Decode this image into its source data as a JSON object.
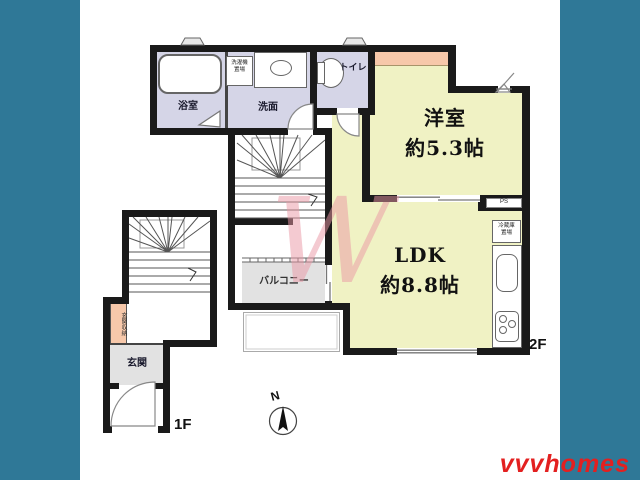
{
  "brand": {
    "logo_text": "vvvhomes",
    "logo_color": "#e32020",
    "watermark_letter": "W"
  },
  "compass": {
    "north_label": "N"
  },
  "floor_labels": {
    "second": "2F",
    "first": "1F"
  },
  "rooms": {
    "bath": {
      "name": "浴室"
    },
    "washroom": {
      "name": "洗面"
    },
    "laundry_space": {
      "name_line1": "洗濯機",
      "name_line2": "置場"
    },
    "toilet": {
      "name": "トイレ"
    },
    "western_room": {
      "name": "洋室",
      "size": "約5.3帖"
    },
    "ldk": {
      "name": "LDK",
      "size": "約8.8帖"
    },
    "pipe_space": {
      "name": "PS"
    },
    "fridge_space": {
      "name_line1": "冷蔵庫",
      "name_line2": "置場"
    },
    "balcony": {
      "name": "バルコニー"
    },
    "entrance_storage": {
      "name": "玄関収納"
    },
    "entrance": {
      "name": "玄関"
    }
  },
  "colors": {
    "frame_border": "#2f7897",
    "wall": "#1a1a1a",
    "room_yellow": "#f0f2c4",
    "room_lavender": "#d5d5e7",
    "accent_salmon": "#f7c8aa",
    "room_gray": "#e2e2e2",
    "label_dark": "#1b1b2e"
  }
}
